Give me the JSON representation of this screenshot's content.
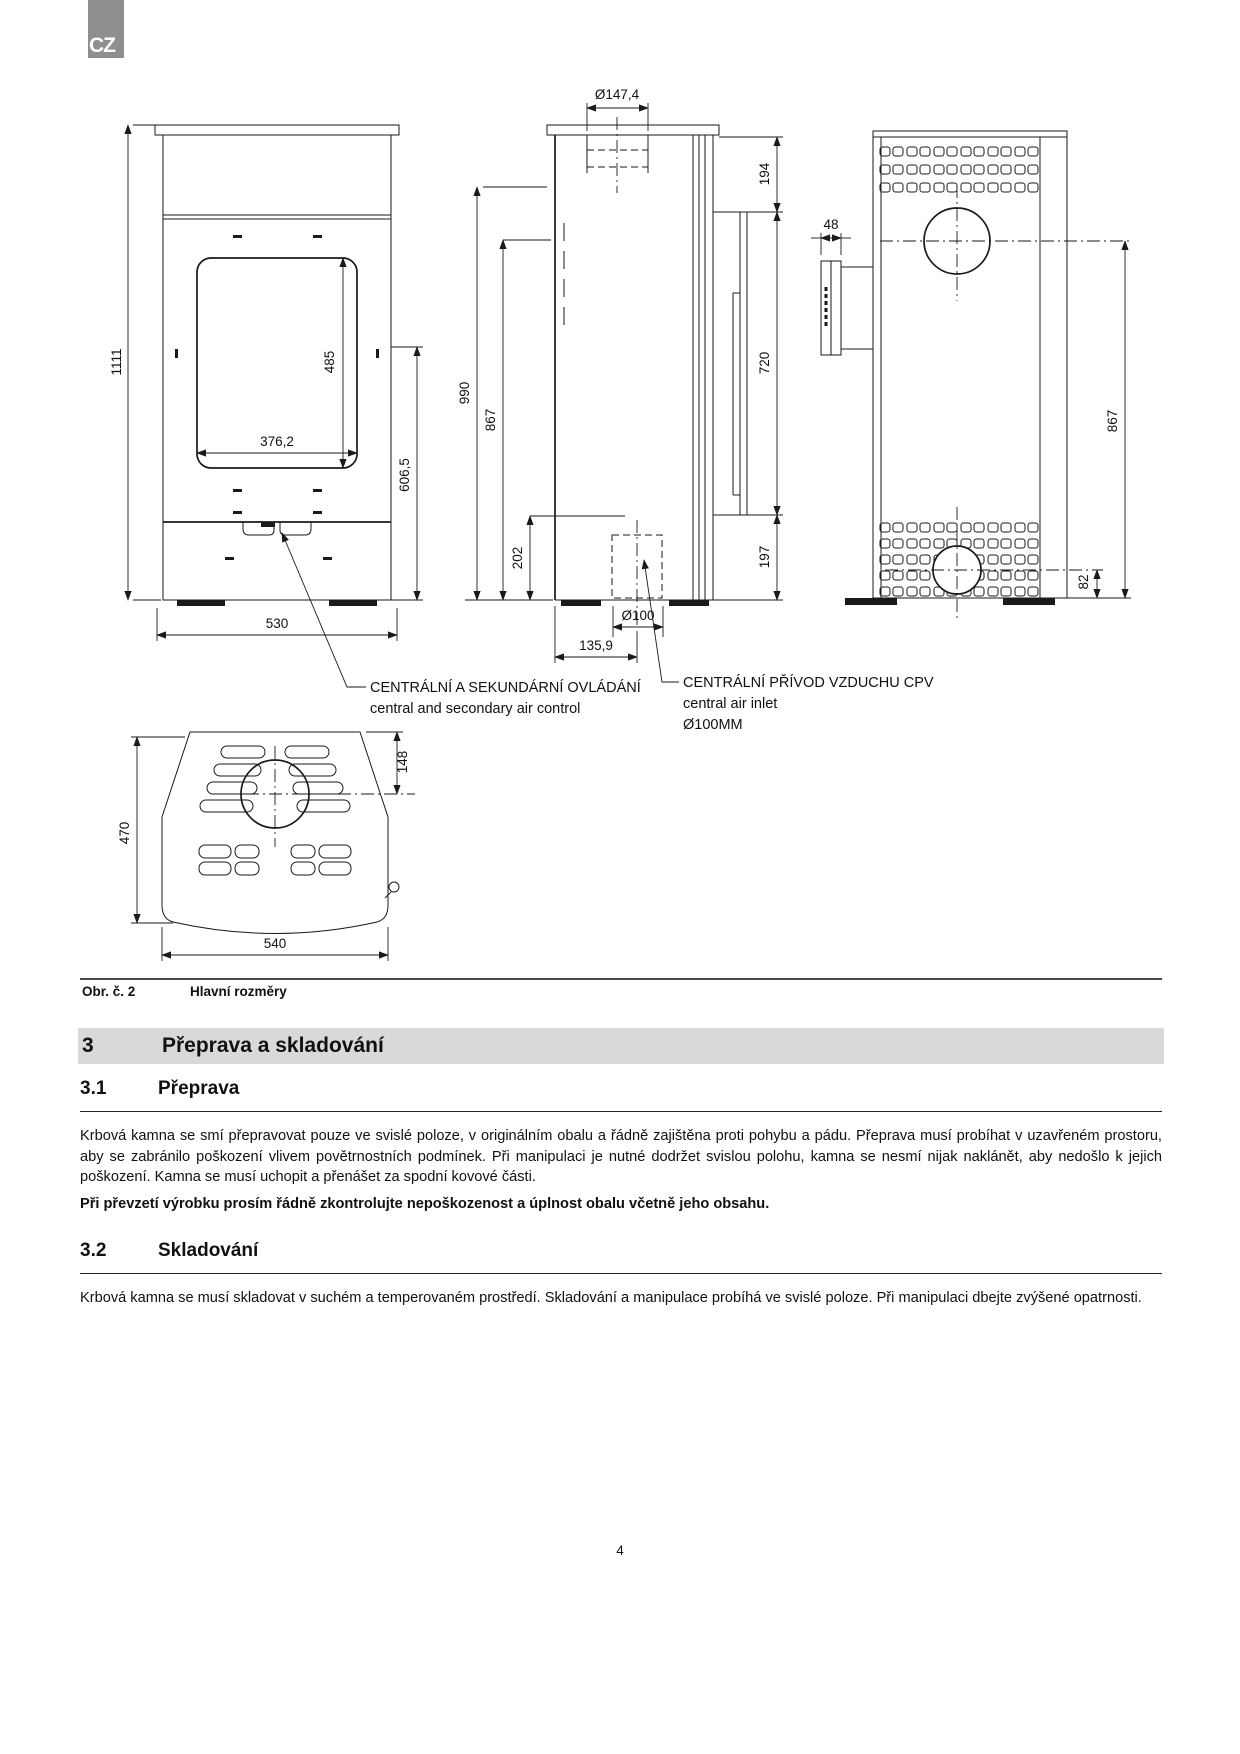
{
  "lang_badge": "CZ",
  "figure": {
    "front": {
      "h": "1111",
      "window_h": "485",
      "window_w": "376,2",
      "door_h": "606,5",
      "w": "530"
    },
    "side": {
      "flue_diameter": "Ø147,4",
      "top_gap": "194",
      "shield_length": "720",
      "bottom_gap": "197",
      "total_height": "990",
      "flue_height": "867",
      "inlet_height": "202",
      "inlet_diameter": "Ø100",
      "inlet_offset": "135,9"
    },
    "back": {
      "handle_depth": "48",
      "flue_center_height": "867",
      "inlet_center_height": "82"
    },
    "top": {
      "depth": "470",
      "flue_center_offset": "148",
      "width": "540"
    },
    "callouts": {
      "control": {
        "cz": "CENTRÁLNÍ A SEKUNDÁRNÍ OVLÁDÁNÍ",
        "en": "central and secondary air control"
      },
      "inlet": {
        "cz": "CENTRÁLNÍ PŘÍVOD VZDUCHU CPV",
        "en": "central air inlet",
        "dia": "Ø100MM"
      }
    }
  },
  "caption": {
    "label": "Obr. č. 2",
    "text": "Hlavní rozměry"
  },
  "section3": {
    "number": "3",
    "title": "Přeprava a skladování"
  },
  "section31": {
    "number": "3.1",
    "title": "Přeprava",
    "paragraph": "Krbová kamna se smí přepravovat pouze ve svislé poloze, v originálním obalu a řádně zajištěna proti pohybu a pádu. Přeprava musí probíhat v uzavřeném prostoru, aby se zabránilo poškození vlivem povětrnostních podmínek. Při manipulaci je nutné dodržet svislou polohu, kamna se nesmí nijak naklánět, aby nedošlo k jejich poškození. Kamna se musí uchopit a přenášet za spodní kovové části.",
    "note": "Při převzetí výrobku prosím řádně zkontrolujte nepoškozenost a úplnost obalu včetně jeho obsahu."
  },
  "section32": {
    "number": "3.2",
    "title": "Skladování",
    "paragraph": "Krbová kamna se musí skladovat v suchém a temperovaném prostředí. Skladování a manipulace probíhá ve svislé poloze. Při manipulaci dbejte zvýšené opatrnosti."
  },
  "page_number": "4"
}
